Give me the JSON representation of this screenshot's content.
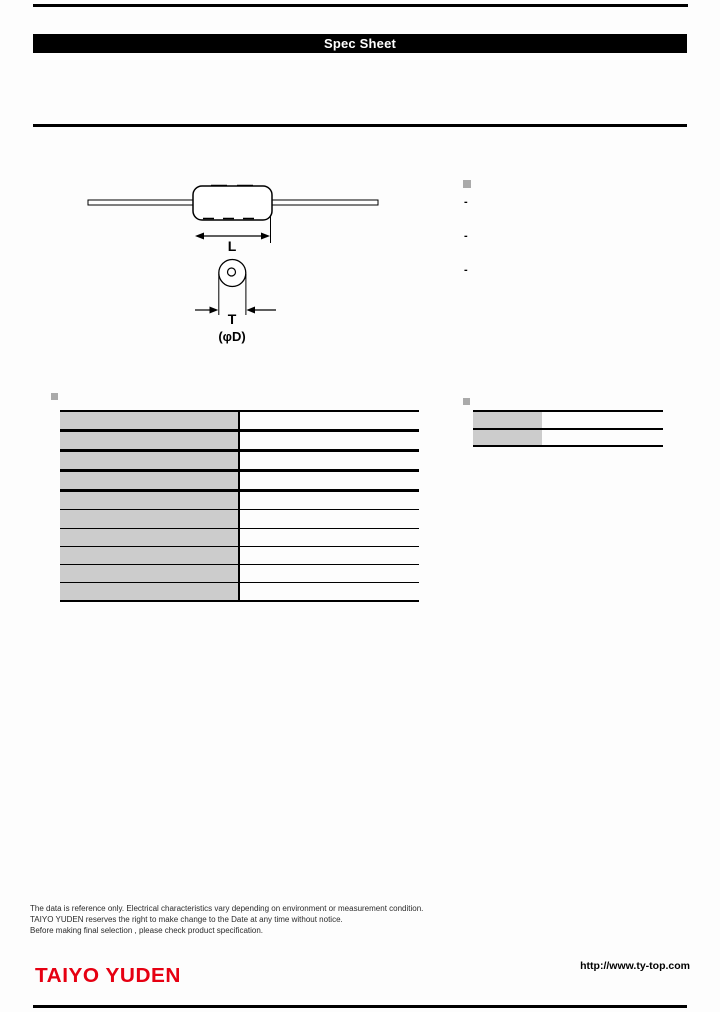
{
  "header": {
    "title": "Spec Sheet"
  },
  "diagram": {
    "length_label": "L",
    "thickness_label": "T",
    "diameter_label": "(φD)"
  },
  "features": {
    "items": [
      "-",
      "-",
      "-"
    ]
  },
  "tables": {
    "left_rows": 10,
    "right_rows": 2
  },
  "colors": {
    "accent_red": "#e60012",
    "cell_gray": "#cccccc",
    "bullet_gray": "#aaaaaa"
  },
  "footer": {
    "notes": [
      "The data is reference only. Electrical characteristics vary depending on environment or measurement condition.",
      "TAIYO YUDEN reserves the right to make change to the Date at any time without notice.",
      "Before making final selection , please check product specification."
    ],
    "url": "http://www.ty-top.com",
    "logo": "TAIYO YUDEN"
  }
}
